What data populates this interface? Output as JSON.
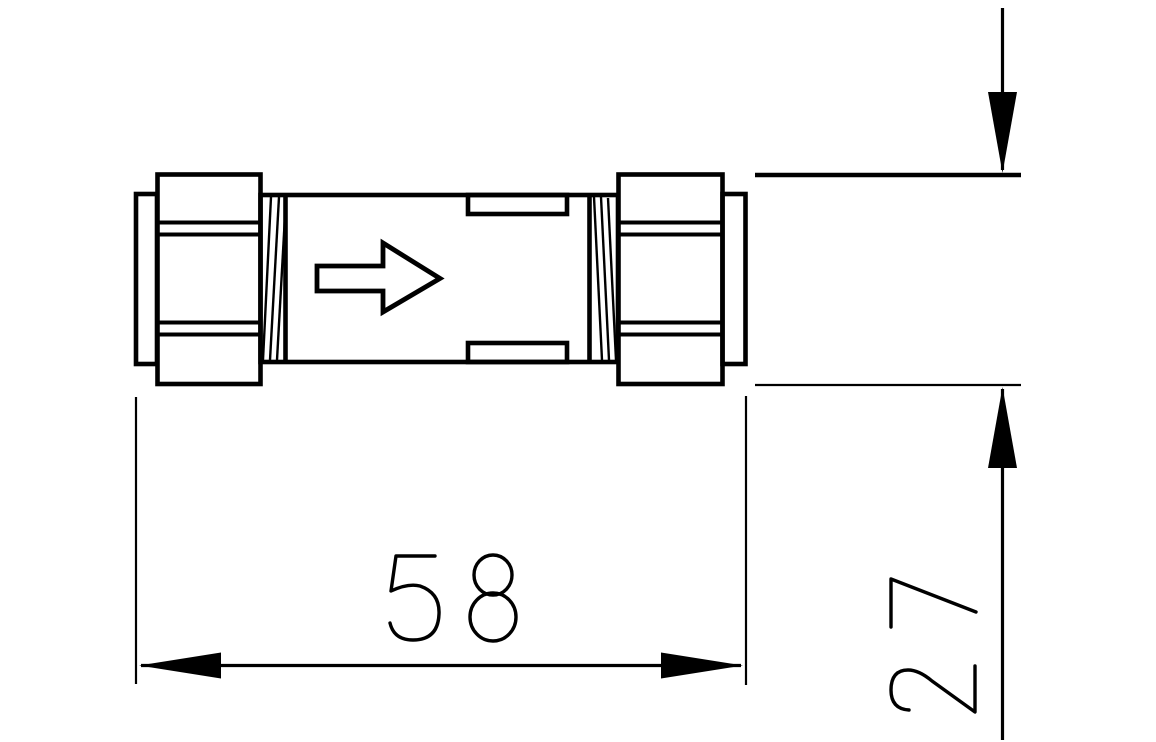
{
  "canvas": {
    "background": "#ffffff",
    "line_color": "#000000"
  },
  "part": {
    "flow_arrow_icon": "right-arrow",
    "flow_direction": "right"
  },
  "dimensions": {
    "length": {
      "value": "58"
    },
    "height": {
      "value": "27"
    }
  }
}
